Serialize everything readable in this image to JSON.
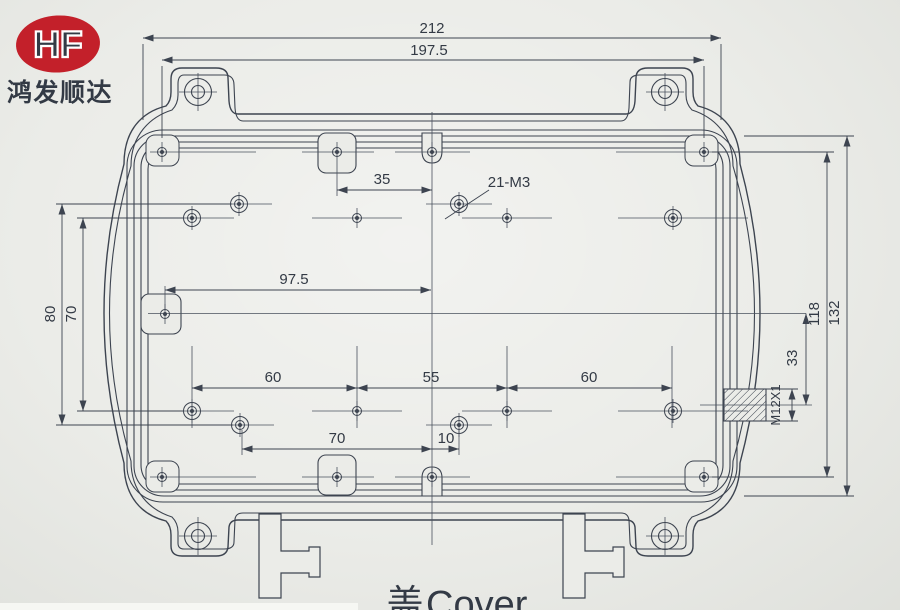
{
  "logo": {
    "monogram": "HF",
    "company": "鸿发顺达"
  },
  "title": {
    "cn": "盖",
    "en": "Cover"
  },
  "dimensions": {
    "overall_width": "212",
    "corner_hole_span": "197.5",
    "top_boss_to_center": "35",
    "thread_callout": "21-M3",
    "left_boss_to_center": "97.5",
    "col_span_left": "60",
    "col_span_mid": "55",
    "col_span_right": "60",
    "bottom_boss_to_center": "70",
    "bottom_offset": "10",
    "left_outer_span": "80",
    "left_inner_span": "70",
    "right_hole_span": "118",
    "body_height": "132",
    "gland_offset": "33",
    "gland_thread": "M12X1"
  },
  "colors": {
    "line": "#3d4450",
    "red": "#c3202a",
    "paper": "#ebece8"
  }
}
